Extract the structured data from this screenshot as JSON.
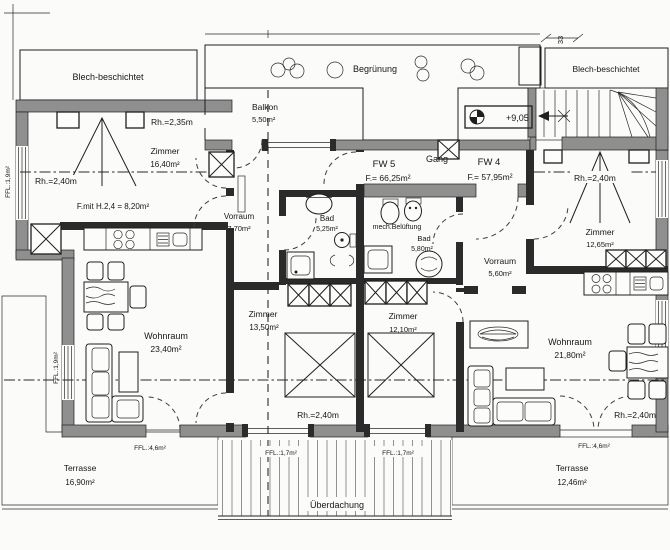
{
  "document_type": "architectural floor plan (attic storey, two flats)",
  "colors": {
    "ink": "#1c1c1c",
    "wall_fill": "#8f8f8f",
    "paper": "#fbfbf9",
    "hatch": "#777777"
  },
  "labels": {
    "blech_left": "Blech-beschichtet",
    "blech_right": "Blech-beschichtet",
    "begruenung": "Begrünung",
    "dim_33": "33",
    "level_marker": "+9,05",
    "gang": "Gang",
    "mech_belueftung": "mech.Belüftung",
    "ueberdachung": "Überdachung",
    "ffl_17_a": "FFL.:1,7m²",
    "ffl_17_b": "FFL.:1,7m²",
    "ffl_46_left": "FFL.:4,6m²",
    "ffl_46_right": "FFL.:4,6m²",
    "ffl_19_top": "FFL.:1,9m²",
    "ffl_19_bottom": "FFL.:1,9m²"
  },
  "balkon": {
    "name": "Balkon",
    "area": "5,50m²"
  },
  "fw5": {
    "id": "FW 5",
    "area": "F.= 66,25m²",
    "zimmer_nw": {
      "name": "Zimmer",
      "area": "16,40m²",
      "rh_top": "Rh.=2,35m",
      "rh_mid": "Rh.=2,40m",
      "f_mit": "F.mit H.2,4 = 8,20m²"
    },
    "vorraum": {
      "name": "Vorraum",
      "area": "7,70m²"
    },
    "bad": {
      "name": "Bad",
      "area": "5,25m²"
    },
    "zimmer_s": {
      "name": "Zimmer",
      "area": "13,50m²",
      "rh": "Rh.=2,40m"
    },
    "wohnraum": {
      "name": "Wohnraum",
      "area": "23,40m²"
    },
    "terrasse": {
      "name": "Terrasse",
      "area": "16,90m²"
    }
  },
  "fw4": {
    "id": "FW 4",
    "area": "F.= 57,95m²",
    "zimmer_ne": {
      "name": "Zimmer",
      "area": "12,65m²",
      "rh": "Rh.=2,40m"
    },
    "vorraum": {
      "name": "Vorraum",
      "area": "5,60m²"
    },
    "bad": {
      "name": "Bad",
      "area": "5,80m²"
    },
    "zimmer_s": {
      "name": "Zimmer",
      "area": "12,10m²"
    },
    "wohnraum": {
      "name": "Wohnraum",
      "area": "21,80m²",
      "rh": "Rh.=2,40m"
    },
    "terrasse": {
      "name": "Terrasse",
      "area": "12,46m²"
    }
  }
}
